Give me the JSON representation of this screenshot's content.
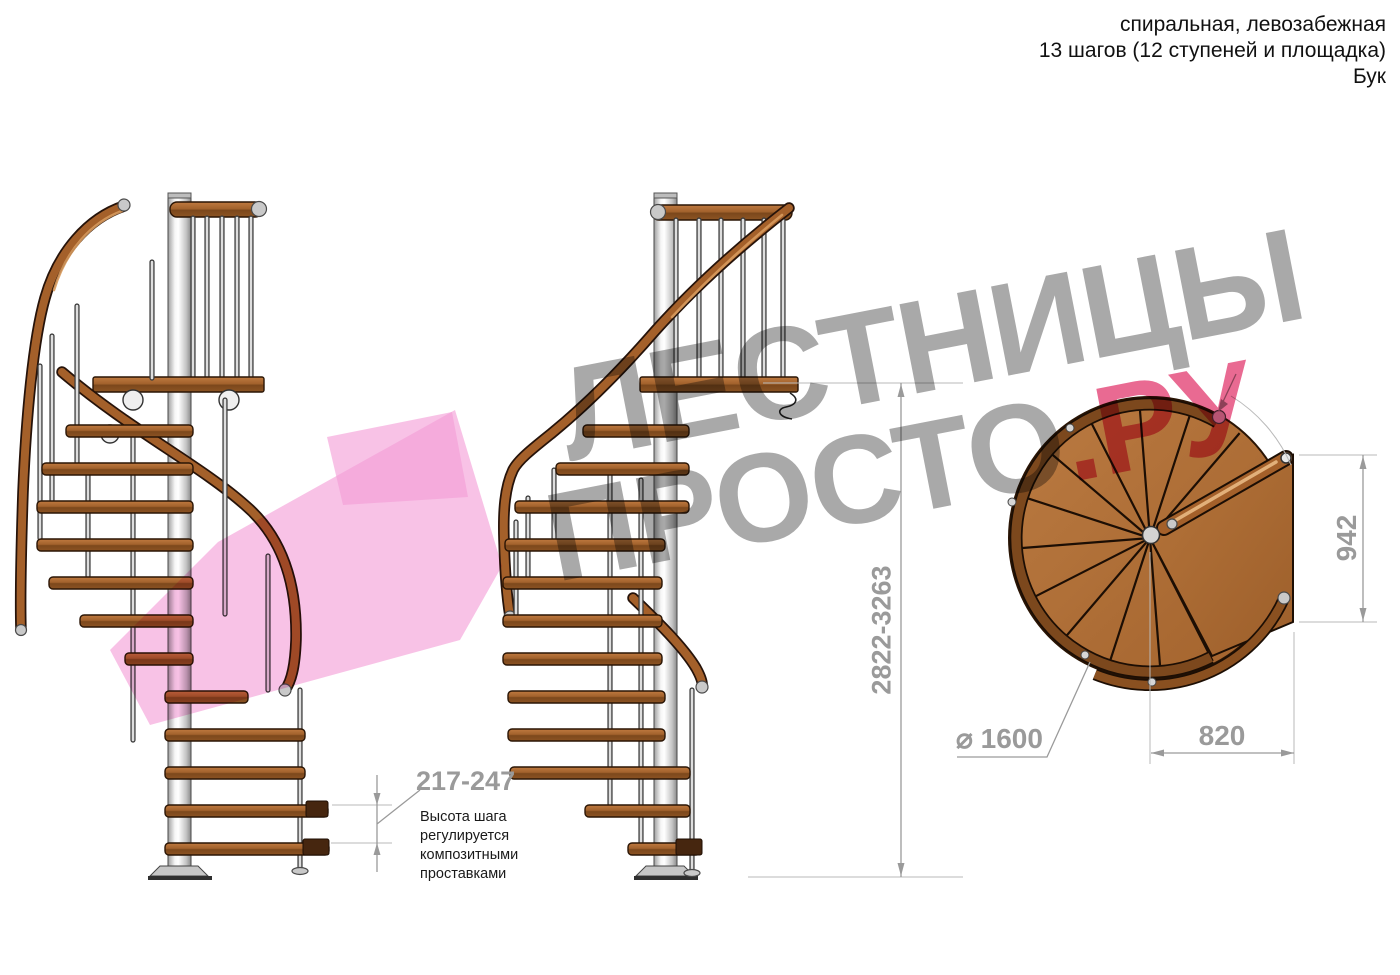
{
  "header": {
    "lines": [
      "спиральная, левозабежная",
      "13 шагов (12 ступеней и площадка)",
      "Бук"
    ]
  },
  "watermark": {
    "word_top": "ЛЕСТНИЦЫ",
    "word_bottom": "ПРОСТО",
    "word_suffix": ".РУ"
  },
  "dimensions": {
    "step_height": "217-247",
    "step_note_lines": [
      "Высота шага",
      "регулируется",
      "композитными",
      "проставками"
    ],
    "total_height": "2822-3263",
    "plan_height": "942",
    "plan_width": "820",
    "diameter": "⌀ 1600"
  },
  "colors": {
    "wood": "#a4602a",
    "wood_dark": "#7c481d",
    "steel": "#d8d8d8",
    "dim_gray": "#9a9a9a",
    "watermark_gray": "#a9a9a9",
    "watermark_pink": "#f49cd6",
    "watermark_red": "#e96a92"
  }
}
